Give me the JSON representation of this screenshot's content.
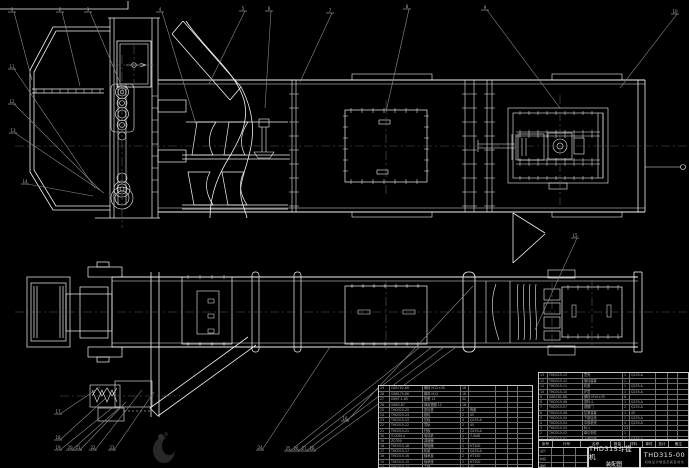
{
  "drawing": {
    "background": "#000000",
    "line_color": "#f2f2f2",
    "leader_color": "#8a8a8a",
    "centerline_color": "#5a5a5a",
    "views": [
      "side-elevation",
      "plan-view"
    ]
  },
  "title_block": {
    "product": "THD315斗提机",
    "sheet_name": "装配图",
    "drawing_no": "THD315-00",
    "org_caption": "机械设计制造及其自动化",
    "sig_labels": [
      "设计",
      "校核",
      "审核"
    ]
  },
  "bom_header": [
    "序号",
    "代号",
    "名称",
    "数量",
    "材料",
    "单件",
    "总计",
    "备注"
  ],
  "bom_right": {
    "rows": [
      [
        "13",
        "THD315-13",
        "罩壳",
        "1",
        "Q235-A",
        "",
        "",
        ""
      ],
      [
        "12",
        "THD315-12",
        "驱动装置",
        "1",
        "",
        "",
        "",
        ""
      ],
      [
        "11",
        "THD315-11",
        "机座",
        "1",
        "Q235-A",
        "",
        "",
        ""
      ],
      [
        "10",
        "THD315-10",
        "护罩",
        "1",
        "Q235-A",
        "",
        "",
        ""
      ],
      [
        "9",
        "GB5782-86",
        "螺栓 M10×35",
        "8",
        "",
        "",
        "",
        ""
      ],
      [
        "8",
        "THD315-08",
        "进料斗",
        "1",
        "Q235-A",
        "",
        "",
        ""
      ],
      [
        "7",
        "THD315-07",
        "观察门",
        "2",
        "Q235-A",
        "",
        "",
        ""
      ],
      [
        "6",
        "THD315-06",
        "拉紧装置",
        "1",
        "45",
        "",
        "",
        ""
      ],
      [
        "5",
        "THD315-05",
        "下部区段",
        "1",
        "Q235-A",
        "",
        "",
        ""
      ],
      [
        "4",
        "THD315-04",
        "中部机壳",
        "4",
        "Q235-A",
        "",
        "",
        ""
      ],
      [
        "3",
        "THD315-03",
        "料斗",
        "23",
        "",
        "",
        "",
        ""
      ],
      [
        "2",
        "THD315-02",
        "牵引构件",
        "1",
        "",
        "",
        "",
        ""
      ],
      [
        "1",
        "THD315-01",
        "上部区段",
        "1",
        "Q235-A",
        "",
        "",
        ""
      ]
    ]
  },
  "bom_left": {
    "rows": [
      [
        "29",
        "GB5782-86",
        "螺栓 M12×45",
        "16",
        "",
        "",
        "",
        ""
      ],
      [
        "28",
        "GB6170-86",
        "螺母 M12",
        "16",
        "",
        "",
        "",
        ""
      ],
      [
        "27",
        "GB97.1-85",
        "垫圈 12",
        "32",
        "",
        "",
        "",
        ""
      ],
      [
        "26",
        "GB93-87",
        "弹簧垫圈 12",
        "16",
        "",
        "",
        "",
        ""
      ],
      [
        "25",
        "THD315-25",
        "密封垫",
        "2",
        "橡胶",
        "",
        "",
        ""
      ],
      [
        "24",
        "THD315-24",
        "链轮",
        "2",
        "45",
        "",
        "",
        ""
      ],
      [
        "23",
        "THD315-23",
        "压板",
        "4",
        "Q235-A",
        "",
        "",
        ""
      ],
      [
        "22",
        "THD315-22",
        "导轨",
        "2",
        "45",
        "",
        "",
        ""
      ],
      [
        "21",
        "THD315-21",
        "托板",
        "2",
        "Q235-A",
        "",
        "",
        ""
      ],
      [
        "20",
        "Y132M-4",
        "电动机",
        "1",
        "7.5kW",
        "",
        "",
        ""
      ],
      [
        "19",
        "ZQ350",
        "减速器",
        "1",
        "",
        "",
        "",
        ""
      ],
      [
        "18",
        "THD315-18",
        "联轴器",
        "1",
        "HT200",
        "",
        "",
        ""
      ],
      [
        "17",
        "THD315-17",
        "机架",
        "1",
        "Q235-A",
        "",
        "",
        ""
      ],
      [
        "16",
        "THD315-16",
        "轴承盖",
        "2",
        "HT150",
        "",
        "",
        ""
      ],
      [
        "15",
        "THD315-15",
        "轴承座",
        "2",
        "HT200",
        "",
        "",
        ""
      ],
      [
        "14",
        "THD315-14",
        "主轴",
        "1",
        "45",
        "",
        "",
        ""
      ]
    ]
  },
  "callouts": [
    {
      "n": "1",
      "x": 12,
      "y": 8,
      "tx": 32,
      "ty": 80
    },
    {
      "n": "2",
      "x": 60,
      "y": 8,
      "tx": 80,
      "ty": 86
    },
    {
      "n": "3",
      "x": 88,
      "y": 8,
      "tx": 124,
      "ty": 92
    },
    {
      "n": "4",
      "x": 160,
      "y": 8,
      "tx": 196,
      "ty": 124
    },
    {
      "n": "5",
      "x": 243,
      "y": 7,
      "tx": 209,
      "ty": 84
    },
    {
      "n": "6",
      "x": 269,
      "y": 7,
      "tx": 265,
      "ty": 108
    },
    {
      "n": "7",
      "x": 330,
      "y": 9,
      "tx": 300,
      "ty": 82
    },
    {
      "n": "8",
      "x": 407,
      "y": 5,
      "tx": 386,
      "ty": 112
    },
    {
      "n": "9",
      "x": 485,
      "y": 6,
      "tx": 560,
      "ty": 108
    },
    {
      "n": "10",
      "x": 675,
      "y": 10,
      "tx": 620,
      "ty": 88
    },
    {
      "n": "11",
      "x": 12,
      "y": 65,
      "tx": 95,
      "ty": 188
    },
    {
      "n": "12",
      "x": 12,
      "y": 100,
      "tx": 100,
      "ty": 190
    },
    {
      "n": "13",
      "x": 13,
      "y": 129,
      "tx": 104,
      "ty": 193
    },
    {
      "n": "14",
      "x": 25,
      "y": 180,
      "tx": 93,
      "ty": 196
    },
    {
      "n": "15",
      "x": 575,
      "y": 234,
      "tx": 535,
      "ty": 330
    },
    {
      "n": "16",
      "x": 345,
      "y": 417,
      "tx": 473,
      "ty": 286
    },
    {
      "n": "17",
      "x": 58,
      "y": 410,
      "tx": 100,
      "ty": 387
    },
    {
      "n": "18",
      "x": 58,
      "y": 436,
      "tx": 106,
      "ty": 398
    },
    {
      "n": "19",
      "x": 58,
      "y": 446,
      "tx": 112,
      "ty": 408
    },
    {
      "n": "20",
      "x": 70,
      "y": 446,
      "tx": 118,
      "ty": 409
    },
    {
      "n": "21",
      "x": 78,
      "y": 446,
      "tx": 126,
      "ty": 402
    },
    {
      "n": "22",
      "x": 93,
      "y": 446,
      "tx": 142,
      "ty": 390
    },
    {
      "n": "23",
      "x": 112,
      "y": 446,
      "tx": 154,
      "ty": 392
    },
    {
      "n": "24",
      "x": 260,
      "y": 446,
      "tx": 330,
      "ty": 347
    },
    {
      "n": "25",
      "x": 288,
      "y": 447,
      "tx": 420,
      "ty": 347
    },
    {
      "n": "26",
      "x": 296,
      "y": 447,
      "tx": 432,
      "ty": 347
    },
    {
      "n": "27",
      "x": 304,
      "y": 447,
      "tx": 444,
      "ty": 347
    },
    {
      "n": "28",
      "x": 312,
      "y": 447,
      "tx": 456,
      "ty": 347
    }
  ]
}
